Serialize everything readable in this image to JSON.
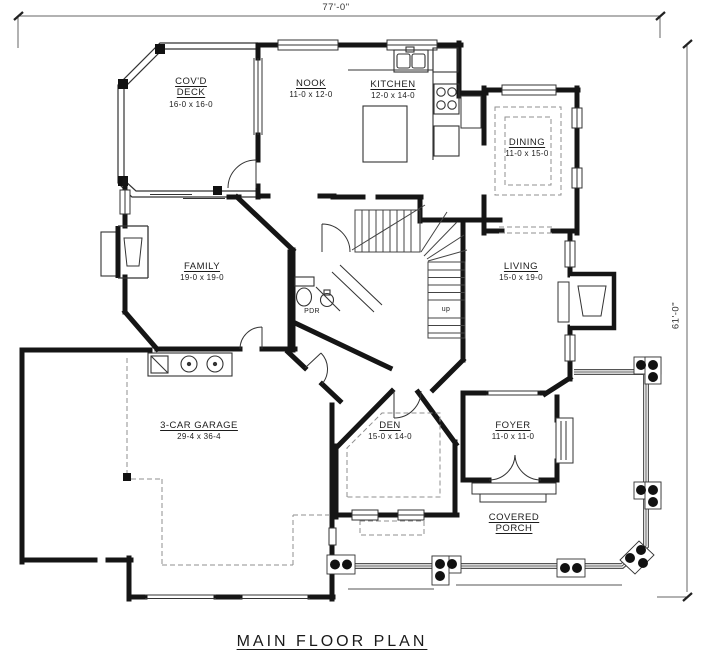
{
  "title": "MAIN FLOOR PLAN",
  "dimensions": {
    "width": "77'-0\"",
    "height": "61'-0\""
  },
  "rooms": [
    {
      "id": "deck",
      "name": "COV'D DECK",
      "size": "16-0 x 16-0"
    },
    {
      "id": "nook",
      "name": "NOOK",
      "size": "11-0 x 12-0"
    },
    {
      "id": "kitchen",
      "name": "KITCHEN",
      "size": "12-0 x 14-0"
    },
    {
      "id": "dining",
      "name": "DINING",
      "size": "11-0 x 15-0"
    },
    {
      "id": "family",
      "name": "FAMILY",
      "size": "19-0 x 19-0"
    },
    {
      "id": "living",
      "name": "LIVING",
      "size": "15-0 x 19-0"
    },
    {
      "id": "garage",
      "name": "3-CAR GARAGE",
      "size": "29-4 x 36-4"
    },
    {
      "id": "den",
      "name": "DEN",
      "size": "15-0 x 14-0"
    },
    {
      "id": "foyer",
      "name": "FOYER",
      "size": "11-0 x 11-0"
    },
    {
      "id": "porch",
      "name": "COVERED PORCH",
      "size": ""
    },
    {
      "id": "pdr",
      "name": "PDR",
      "size": ""
    }
  ],
  "annotations": {
    "stair_direction": "up"
  },
  "colors": {
    "wall": "#151515",
    "line": "#3a3a3a",
    "dash": "#8f8f8f",
    "background": "#ffffff"
  }
}
